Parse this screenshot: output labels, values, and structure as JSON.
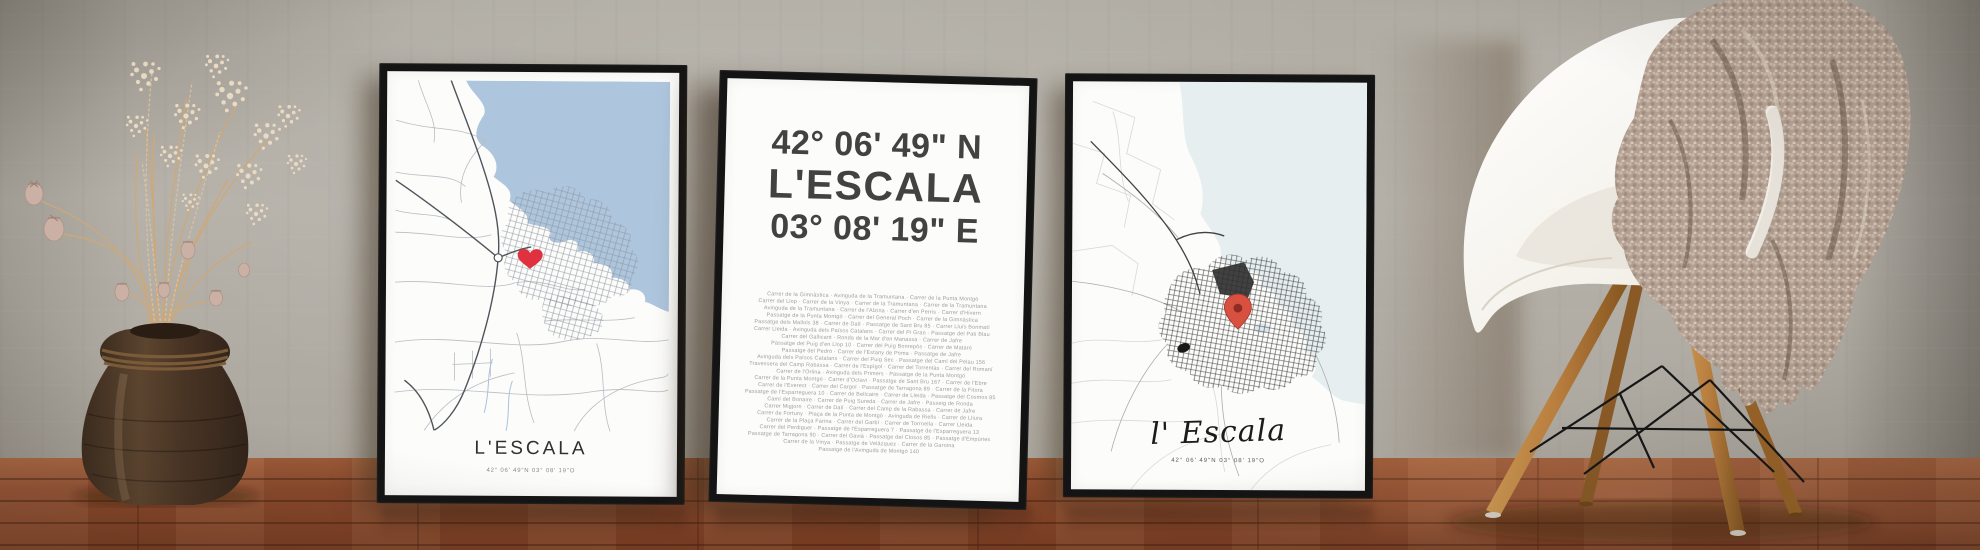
{
  "scene_type": "photo of three framed L'Escala map posters leaning on a wall with vase of dried flowers and a chair with knit blanket",
  "posters": {
    "left_map": {
      "title": "L'ESCALA",
      "coordinates": "42° 06' 49\"N 03° 08' 19\"O",
      "marker": "heart-icon"
    },
    "typography": {
      "latitude": "42° 06' 49\" N",
      "city": "L'ESCALA",
      "longitude": "03° 08' 19\" E",
      "street_lines": [
        "Carrer de la Gimnàstica · Avinguda de la Tramuntana · Carrer de la Punta Montgó",
        "Carrer del Llop · Carrer de la Vinya · Carrer de la Tramuntana · Carrer de la Tramuntana",
        "Avinguda de la Tramuntana · Carrer de l'Alzina · Carrer d'en Perris · Carrer d'Hivern",
        "Passatge de la Punta Montgó · Carrer del General Poch · Carrer de la Gimnàstica",
        "Passatge dels Mallols 38 · Carrer de Dalt · Passatge de Sant Bru 85 · Carrer Lluís Bonmatí",
        "Carrer Lleida · Avinguda dels Països Catalans · Carrer del Pi Gran · Passatge del Pati Blau",
        "Carrer del Gallicant · Ronda de la Mar d'en Manassa · Carrer de Jafre",
        "Passatge del Puig d'en Llop 10 · Carrer del Puig Bonrepòs · Carrer de Mataró",
        "Passatge del Pedró · Carrer de l'Estany de Poma · Passatge de Jafre",
        "Avinguda dels Països Catalans · Carrer del Puig Sec · Passatge del Camí del Pelau 156",
        "Travessera del Camp Rabassa · Carrer de l'Espígol · Carrer del Torrentàs · Carrer del Romaní",
        "Carrer de l'Orlina · Avinguda dels Primers · Passatge de la Punta Montgó",
        "Carrer de la Punta Montgó · Carrer d'Octavi · Passatge de Sant Bru 167 · Carrer de l'Ebre",
        "Carrer de l'Everest · Carrer del Cargol · Passatge de Tarragona 89 · Carrer de la Fitora",
        "Passatge de l'Esparreguera 10 · Carrer de Bellcaire · Carrer de Lleida · Passatge del Cosmos 85",
        "Camí del Bonaire · Carrer de Puig Sureda · Carrer de Jafre · Passeig de Ronda",
        "Carrer Migjorn · Carrer de Dalí · Carrer del Camp de la Rabassa · Carrer de Jafre",
        "Carrer de Fortuny · Plaça de la Punta de Montgó · Avinguda de Riells · Carrer de Lliura",
        "Carrer de la Plaça Farina · Carrer del Garbí · Carrer de Torroella · Carrer Lleida",
        "Carrer del Perdiguer · Passatge de l'Esparreguera 7 · Passatge de l'Esparreguera 13",
        "Passatge de Tarragona 90 · Carrer del Gavià · Passatge del Closos 85 · Passatge d'Empúries",
        "Carrer de la Vinya · Passatge de Velázquez · Carrer de la Garoina",
        "Passatge de l'Avinguda de Montgó 140"
      ]
    },
    "right_map": {
      "title": "l' Escala",
      "coordinates": "42° 06' 49\"N 03° 08' 19\"O",
      "marker": "map-pin-icon"
    }
  },
  "colors": {
    "wall": "#b4b0a8",
    "floor_wood": "#8d4c2e",
    "frame": "#141414",
    "poster_paper": "#fcfcfa",
    "sea_blue": "#adc5dd",
    "sea_pale": "#e6eef0",
    "road_light": "#b8bdc4",
    "road_dark": "#4f545c",
    "town_ink": "#3a3a3a",
    "heart_red": "#e0313f",
    "pin_red": "#d8503f",
    "chair_shell": "#f6f3ee",
    "chair_leg_wood": "#b97e3e",
    "blanket_taupe": "#b3a092",
    "vase_brown": "#4e3a28",
    "dried_flowers": "#e4cdab"
  }
}
